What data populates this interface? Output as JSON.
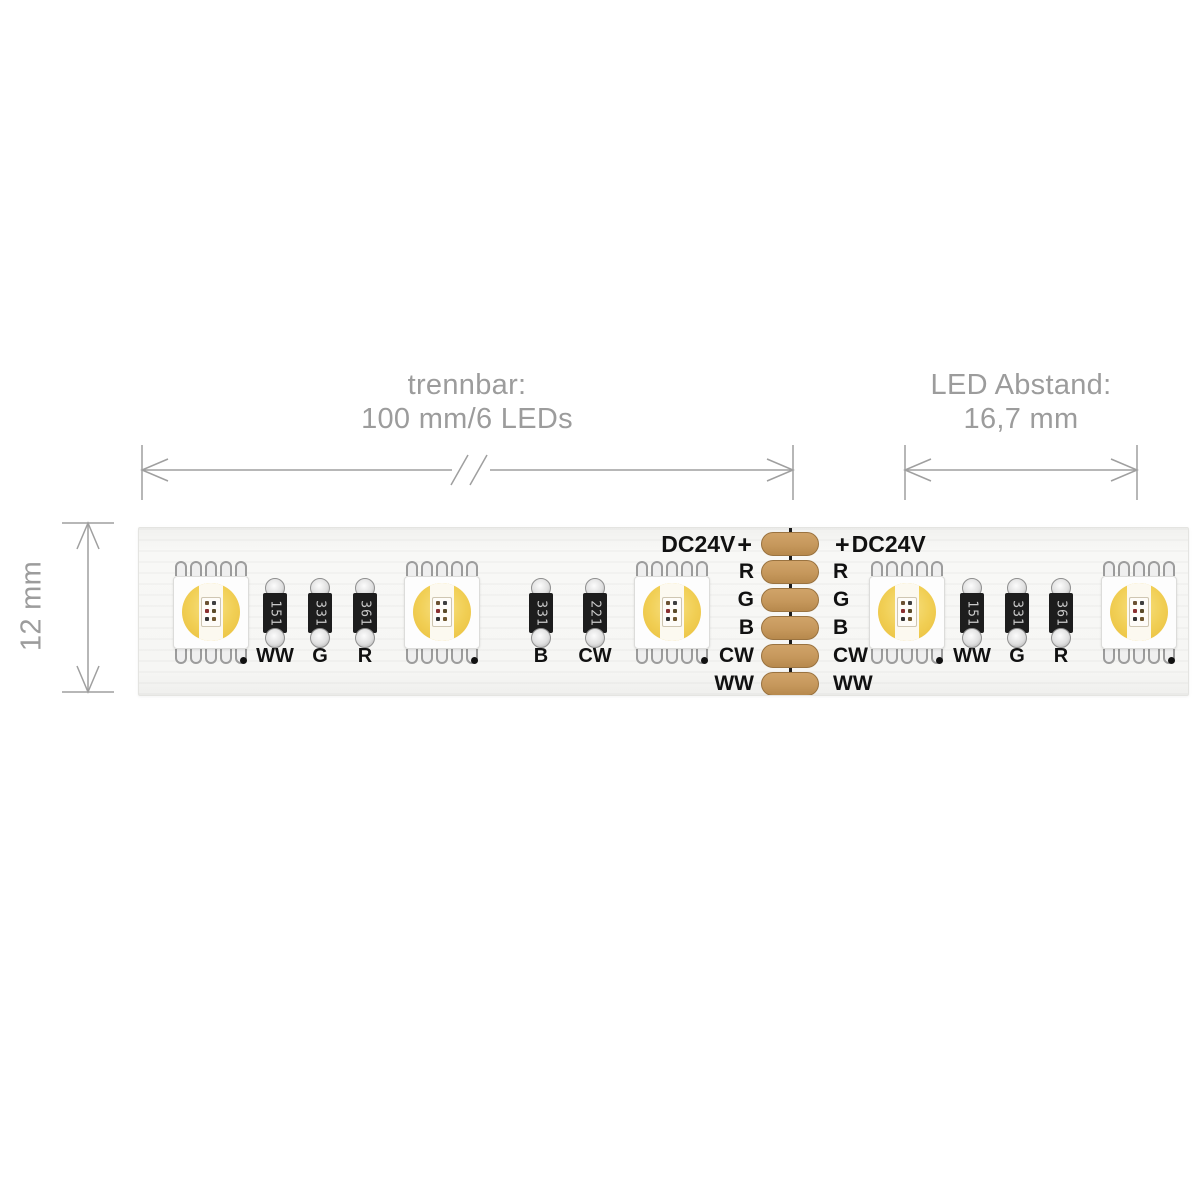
{
  "dimensions": {
    "separable_line1": "trennbar:",
    "separable_line2": "100 mm/6 LEDs",
    "spacing_line1": "LED Abstand:",
    "spacing_line2": "16,7 mm",
    "width_label": "12 mm"
  },
  "connector": {
    "voltage": "DC24V",
    "plus": "+",
    "channels": [
      "R",
      "G",
      "B",
      "CW",
      "WW"
    ],
    "pad_count": 6,
    "pad_color": "#C6985C"
  },
  "resistors": [
    {
      "code": "151",
      "label": "WW"
    },
    {
      "code": "331",
      "label": "G"
    },
    {
      "code": "361",
      "label": "R"
    },
    {
      "code": "331",
      "label": "B"
    },
    {
      "code": "221",
      "label": "CW"
    },
    {
      "code": "151",
      "label": "WW"
    },
    {
      "code": "331",
      "label": "G"
    },
    {
      "code": "361",
      "label": "R"
    }
  ],
  "led_count": 5,
  "colors": {
    "dimension_gray": "#9C9C9C",
    "label_black": "#111111",
    "lens_yellow": "#F1CF55",
    "strip_white": "#F6F6F4"
  }
}
